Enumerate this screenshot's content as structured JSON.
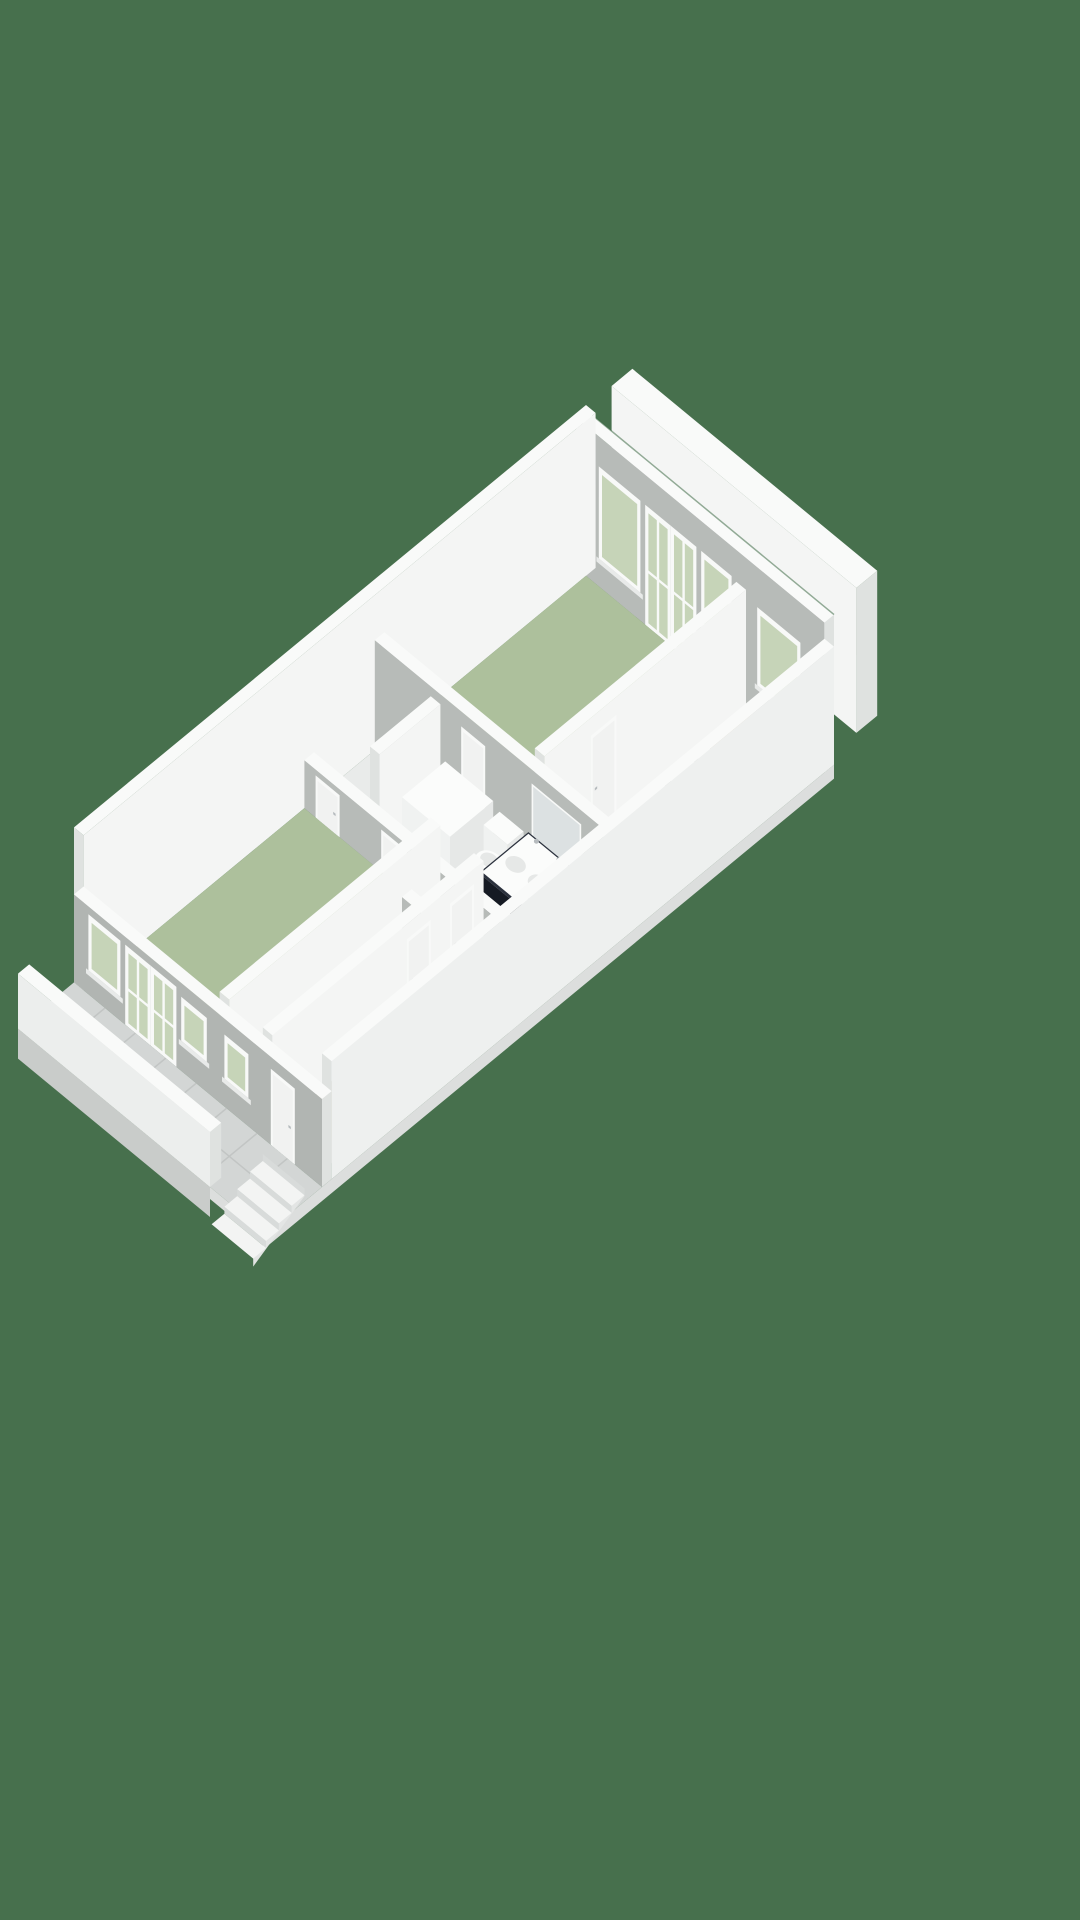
{
  "scene": {
    "canvas": {
      "width": 1080,
      "height": 1920
    },
    "iso": {
      "k": 0.8,
      "s": 0.66,
      "ox": 586,
      "oy": 560
    },
    "colors": {
      "background": "#47704d",
      "wall_top": "#f9faf9",
      "wall_light": "#f4f5f4",
      "wall_lighter": "#eef0ef",
      "wall_cap": "#dfe2e0",
      "wall_shade": "#b7bbb8",
      "facade": "#b1b5b2",
      "floor_green": "#adc09c",
      "floor_beige": "#c8bfaa",
      "floor_hall": "#c2b9a6",
      "floor_white": "#e9ebea",
      "tile": "#d3d6d5",
      "tile_seam": "#c2c5c4",
      "glazing": "#c6d4b8",
      "frame": "#f8f9f8",
      "sill": "#e8eae9",
      "door_panel": "#f1f2f1",
      "fixture_white": "#fbfcfb",
      "fixture_shade": "#e6e8e7",
      "fixture_side": "#f0f2f1",
      "vanity_top": "#2b313d",
      "vanity_front": "#151a23",
      "vanity_side": "#1f2530",
      "glass": "rgba(228,234,237,0.55)",
      "glass_edge": "#c7cdd1",
      "metal": "#b6bbbe",
      "step_top": "#f3f4f3",
      "step_riser": "#d8dbda",
      "step_side": "#e3e5e4",
      "base_edge": "#c9ccca",
      "base_light": "#dcdedd",
      "parapet_face": "#eceeed",
      "mirror": "#dce1e2",
      "seam_line": "#3e6a46"
    },
    "elements": [
      {
        "t": "box",
        "name": "neighbor-party-wall",
        "x1": -6,
        "y1": -64,
        "x2": 300,
        "y2": -38,
        "h": 145,
        "top": "wall_top",
        "fx": "wall_cap",
        "fy": "wall_light"
      },
      {
        "t": "box",
        "name": "exterior-wall-ne",
        "x1": 0,
        "y1": 0,
        "x2": 310,
        "y2": 12,
        "h": 150,
        "top": "wall_top",
        "fx": "wall_cap",
        "fy": "wall_shade"
      },
      {
        "t": "seam",
        "name": "wall-gap-shadow",
        "pts": [
          [
            0,
            0,
            150
          ],
          [
            310,
            0,
            150
          ]
        ]
      },
      {
        "t": "opening",
        "name": "bedroom-window",
        "plane": "y",
        "at": 12,
        "a1": 28,
        "a2": 80,
        "z1": 28,
        "z2": 120,
        "glaze": true,
        "sill": true
      },
      {
        "t": "opening",
        "name": "bedroom-french-door",
        "plane": "y",
        "at": 12,
        "a1": 86,
        "a2": 118,
        "z1": 0,
        "z2": 120,
        "glaze": true,
        "door": true
      },
      {
        "t": "opening",
        "name": "bedroom-french-door",
        "plane": "y",
        "at": 12,
        "a1": 118,
        "a2": 150,
        "z1": 0,
        "z2": 120,
        "glaze": true,
        "door": true
      },
      {
        "t": "opening",
        "name": "bedroom-window",
        "plane": "y",
        "at": 12,
        "a1": 156,
        "a2": 194,
        "z1": 28,
        "z2": 120,
        "glaze": true,
        "sill": true
      },
      {
        "t": "opening",
        "name": "wc-window",
        "plane": "y",
        "at": 12,
        "a1": 226,
        "a2": 280,
        "z1": 32,
        "z2": 110,
        "glaze": true,
        "sill": true
      },
      {
        "t": "box",
        "name": "exterior-wall-nw",
        "x1": 0,
        "y1": 0,
        "x2": 12,
        "y2": 640,
        "h": 155,
        "top": "wall_top",
        "fx": "wall_light",
        "fy": "wall_cap"
      },
      {
        "t": "floor",
        "name": "room-floor-bedroom",
        "x1": 12,
        "y1": 12,
        "x2": 200,
        "y2": 264,
        "fill": "floor_green"
      },
      {
        "t": "floor",
        "name": "room-floor-wc",
        "x1": 212,
        "y1": 12,
        "x2": 298,
        "y2": 110,
        "fill": "floor_beige"
      },
      {
        "t": "floor",
        "name": "room-floor-landing",
        "x1": 212,
        "y1": 122,
        "x2": 298,
        "y2": 264,
        "fill": "floor_white"
      },
      {
        "t": "floor",
        "name": "room-floor-closet",
        "x1": 12,
        "y1": 276,
        "x2": 82,
        "y2": 352,
        "fill": "floor_white"
      },
      {
        "t": "floor",
        "name": "room-floor-bathroom",
        "x1": 94,
        "y1": 276,
        "x2": 298,
        "y2": 352,
        "fill": "floor_white"
      },
      {
        "t": "floor",
        "name": "room-floor-living-room",
        "x1": 12,
        "y1": 364,
        "x2": 170,
        "y2": 628,
        "fill": "floor_green"
      },
      {
        "t": "floor",
        "name": "room-floor-storage",
        "x1": 182,
        "y1": 364,
        "x2": 224,
        "y2": 400,
        "fill": "floor_white"
      },
      {
        "t": "floor",
        "name": "room-floor-bedroom-2",
        "x1": 182,
        "y1": 412,
        "x2": 224,
        "y2": 628,
        "fill": "floor_green"
      },
      {
        "t": "floor",
        "name": "room-floor-hallway",
        "x1": 236,
        "y1": 364,
        "x2": 298,
        "y2": 628,
        "fill": "floor_hall"
      },
      {
        "t": "box",
        "name": "wc-toilet-tank",
        "x1": 248,
        "y1": 96,
        "x2": 278,
        "y2": 110,
        "h": 40,
        "top": "fixture_white",
        "fx": "fixture_shade",
        "fy": "fixture_side"
      },
      {
        "t": "pellipse",
        "name": "wc-toilet",
        "cx": 262,
        "cy": 82,
        "rx": 13,
        "ry": 10,
        "z": 18,
        "fill": "fixture_white"
      },
      {
        "t": "pellipse",
        "name": "wc-toilet-seat",
        "cx": 262,
        "cy": 82,
        "rx": 8,
        "ry": 6,
        "z": 20,
        "fill": "fixture_shade"
      },
      {
        "t": "box",
        "name": "wall-wc-front",
        "x1": 212,
        "y1": 110,
        "x2": 298,
        "y2": 122,
        "h": 55,
        "top": "wall_top",
        "fx": "wall_cap",
        "fy": "wall_shade"
      },
      {
        "t": "opening",
        "name": "wc-door",
        "plane": "y",
        "at": 122,
        "a1": 228,
        "a2": 258,
        "z1": 0,
        "z2": 48,
        "door": true
      },
      {
        "t": "box",
        "name": "wall-bedroom-side",
        "x1": 200,
        "y1": 12,
        "x2": 212,
        "y2": 264,
        "h": 118,
        "top": "wall_top",
        "fx": "wall_light",
        "fy": "wall_cap"
      },
      {
        "t": "opening",
        "name": "bedroom-door",
        "plane": "x",
        "at": 212,
        "a1": 174,
        "a2": 206,
        "z1": 0,
        "z2": 100,
        "door": true
      },
      {
        "t": "box",
        "name": "wall-central",
        "x1": 12,
        "y1": 264,
        "x2": 298,
        "y2": 276,
        "h": 110,
        "top": "wall_top",
        "fx": "wall_cap",
        "fy": "wall_shade"
      },
      {
        "t": "opening",
        "name": "bathroom-door",
        "plane": "y",
        "at": 276,
        "a1": 120,
        "a2": 150,
        "z1": 0,
        "z2": 95,
        "door": true
      },
      {
        "t": "opening",
        "name": "bathroom-mirror",
        "plane": "y",
        "at": 276,
        "a1": 208,
        "a2": 270,
        "z1": 36,
        "z2": 96,
        "mirror": true
      },
      {
        "t": "box",
        "name": "wall-closet-side",
        "x1": 82,
        "y1": 276,
        "x2": 94,
        "y2": 352,
        "h": 100,
        "top": "wall_top",
        "fx": "wall_light",
        "fy": "wall_cap"
      },
      {
        "t": "box",
        "name": "bathtub",
        "x1": 104,
        "y1": 280,
        "x2": 164,
        "y2": 334,
        "h": 52,
        "top": "fixture_white",
        "fx": "fixture_shade",
        "fy": "fixture_side"
      },
      {
        "t": "box",
        "name": "toilet-tank",
        "x1": 170,
        "y1": 278,
        "x2": 200,
        "y2": 298,
        "h": 44,
        "top": "fixture_white",
        "fx": "fixture_shade",
        "fy": "fixture_side"
      },
      {
        "t": "pellipse",
        "name": "toilet",
        "cx": 185,
        "cy": 306,
        "rx": 14,
        "ry": 11,
        "z": 22,
        "fill": "fixture_white"
      },
      {
        "t": "pellipse",
        "name": "toilet-seat",
        "cx": 185,
        "cy": 306,
        "rx": 9,
        "ry": 7,
        "z": 24,
        "fill": "fixture_shade"
      },
      {
        "t": "box",
        "name": "vanity-cabinet",
        "x1": 208,
        "y1": 280,
        "x2": 272,
        "y2": 342,
        "h": 50,
        "top": "vanity_top",
        "fx": "vanity_side",
        "fy": "vanity_front"
      },
      {
        "t": "floorz",
        "name": "vanity-counter",
        "x1": 210,
        "y1": 282,
        "x2": 270,
        "y2": 340,
        "z": 51,
        "fill": "fixture_white"
      },
      {
        "t": "pellipse",
        "name": "sink-basin",
        "cx": 226,
        "cy": 314,
        "rx": 10,
        "ry": 8,
        "z": 52,
        "fill": "fixture_shade"
      },
      {
        "t": "pellipse",
        "name": "sink-basin",
        "cx": 254,
        "cy": 314,
        "rx": 10,
        "ry": 8,
        "z": 52,
        "fill": "fixture_shade"
      },
      {
        "t": "dot",
        "name": "faucet",
        "x": 226,
        "y": 288,
        "z": 58,
        "r": 2.5,
        "fill": "metal"
      },
      {
        "t": "dot",
        "name": "faucet",
        "x": 254,
        "y": 288,
        "z": 58,
        "r": 2.5,
        "fill": "metal"
      },
      {
        "t": "vquad",
        "name": "shower-screen",
        "pts": [
          [
            276,
            280,
            0
          ],
          [
            276,
            348,
            0
          ],
          [
            276,
            348,
            80
          ],
          [
            276,
            280,
            80
          ]
        ],
        "fill": "glass",
        "stroke": "glass_edge"
      },
      {
        "t": "vquad",
        "name": "shower-door",
        "pts": [
          [
            276,
            348,
            0
          ],
          [
            290,
            360,
            0
          ],
          [
            290,
            360,
            76
          ],
          [
            276,
            348,
            76
          ]
        ],
        "fill": "glass",
        "stroke": "glass_edge"
      },
      {
        "t": "dot",
        "name": "shower-handle",
        "x": 276,
        "y": 316,
        "z": 55,
        "r": 3,
        "fill": "metal"
      },
      {
        "t": "box",
        "name": "wall-bathroom-front",
        "x1": 12,
        "y1": 352,
        "x2": 298,
        "y2": 364,
        "h": 48,
        "top": "wall_top",
        "fx": "wall_cap",
        "fy": "wall_shade"
      },
      {
        "t": "opening",
        "name": "closet-door",
        "plane": "y",
        "at": 364,
        "a1": 26,
        "a2": 56,
        "z1": 0,
        "z2": 42,
        "door": true
      },
      {
        "t": "opening",
        "name": "bathroom-hall-door",
        "plane": "y",
        "at": 364,
        "a1": 108,
        "a2": 140,
        "z1": 0,
        "z2": 42,
        "door": true
      },
      {
        "t": "opening",
        "name": "hall-door",
        "plane": "y",
        "at": 364,
        "a1": 252,
        "a2": 284,
        "z1": 0,
        "z2": 42,
        "door": true
      },
      {
        "t": "box",
        "name": "wall-living-side",
        "x1": 170,
        "y1": 364,
        "x2": 182,
        "y2": 628,
        "h": 95,
        "top": "wall_top",
        "fx": "wall_light",
        "fy": "wall_cap"
      },
      {
        "t": "box",
        "name": "wall-storage-front",
        "x1": 182,
        "y1": 400,
        "x2": 224,
        "y2": 412,
        "h": 55,
        "top": "wall_top",
        "fx": "wall_cap",
        "fy": "wall_shade"
      },
      {
        "t": "box",
        "name": "wall-hall-side",
        "x1": 224,
        "y1": 364,
        "x2": 236,
        "y2": 628,
        "h": 95,
        "top": "wall_top",
        "fx": "wall_light",
        "fy": "wall_cap"
      },
      {
        "t": "opening",
        "name": "hallway-door",
        "plane": "x",
        "at": 236,
        "a1": 376,
        "a2": 406,
        "z1": 0,
        "z2": 80,
        "door": true
      },
      {
        "t": "opening",
        "name": "hallway-door",
        "plane": "x",
        "at": 236,
        "a1": 430,
        "a2": 460,
        "z1": 0,
        "z2": 80,
        "door": true
      },
      {
        "t": "stairs",
        "name": "staircase",
        "x1": 248,
        "x2": 294,
        "y0": 440,
        "n": 6,
        "dy": 14,
        "z0": 12,
        "dz": 5
      },
      {
        "t": "box",
        "name": "exterior-wall-se",
        "x1": 298,
        "y1": 0,
        "x2": 310,
        "y2": 628,
        "h": 118,
        "top": "wall_top",
        "fx": "wall_lighter",
        "fy": "wall_cap"
      },
      {
        "t": "box",
        "name": "exterior-wall-front",
        "x1": 0,
        "y1": 628,
        "x2": 310,
        "y2": 640,
        "h": 88,
        "top": "wall_top",
        "fx": "wall_cap",
        "fy": "facade"
      },
      {
        "t": "opening",
        "name": "living-window",
        "plane": "y",
        "at": 640,
        "a1": 18,
        "a2": 58,
        "z1": 24,
        "z2": 80,
        "glaze": true,
        "sill": true
      },
      {
        "t": "opening",
        "name": "living-french-door",
        "plane": "y",
        "at": 640,
        "a1": 64,
        "a2": 96,
        "z1": 0,
        "z2": 80,
        "glaze": true,
        "door": true
      },
      {
        "t": "opening",
        "name": "living-french-door",
        "plane": "y",
        "at": 640,
        "a1": 96,
        "a2": 128,
        "z1": 0,
        "z2": 80,
        "glaze": true,
        "door": true
      },
      {
        "t": "opening",
        "name": "living-window",
        "plane": "y",
        "at": 640,
        "a1": 134,
        "a2": 166,
        "z1": 30,
        "z2": 74,
        "glaze": true,
        "sill": true
      },
      {
        "t": "opening",
        "name": "bedroom2-window",
        "plane": "y",
        "at": 640,
        "a1": 188,
        "a2": 218,
        "z1": 28,
        "z2": 72,
        "glaze": true,
        "sill": true
      },
      {
        "t": "opening",
        "name": "entrance-door",
        "plane": "y",
        "at": 640,
        "a1": 246,
        "a2": 276,
        "z1": 0,
        "z2": 76,
        "door": true
      },
      {
        "t": "floor",
        "name": "balcony-floor",
        "x1": 0,
        "y1": 640,
        "x2": 310,
        "y2": 710,
        "fill": "tile"
      },
      {
        "t": "floor",
        "name": "tile-seam",
        "x1": 38,
        "y1": 640,
        "x2": 39.5,
        "y2": 710,
        "fill": "tile_seam"
      },
      {
        "t": "floor",
        "name": "tile-seam",
        "x1": 76,
        "y1": 640,
        "x2": 77.5,
        "y2": 710,
        "fill": "tile_seam"
      },
      {
        "t": "floor",
        "name": "tile-seam",
        "x1": 114,
        "y1": 640,
        "x2": 115.5,
        "y2": 710,
        "fill": "tile_seam"
      },
      {
        "t": "floor",
        "name": "tile-seam",
        "x1": 152,
        "y1": 640,
        "x2": 153.5,
        "y2": 710,
        "fill": "tile_seam"
      },
      {
        "t": "floor",
        "name": "tile-seam",
        "x1": 190,
        "y1": 640,
        "x2": 191.5,
        "y2": 710,
        "fill": "tile_seam"
      },
      {
        "t": "floor",
        "name": "tile-seam",
        "x1": 228,
        "y1": 640,
        "x2": 229.5,
        "y2": 710,
        "fill": "tile_seam"
      },
      {
        "t": "floor",
        "name": "tile-seam",
        "x1": 266,
        "y1": 640,
        "x2": 267.5,
        "y2": 710,
        "fill": "tile_seam"
      },
      {
        "t": "floor",
        "name": "tile-seam",
        "x1": 0,
        "y1": 674,
        "x2": 310,
        "y2": 675.5,
        "fill": "tile_seam"
      },
      {
        "t": "vquad",
        "name": "balcony-base",
        "pts": [
          [
            0,
            710,
            0
          ],
          [
            240,
            710,
            0
          ],
          [
            240,
            710,
            -30
          ],
          [
            0,
            710,
            -30
          ]
        ],
        "fill": "base_edge"
      },
      {
        "t": "vquad",
        "name": "porch-base",
        "pts": [
          [
            240,
            710,
            0
          ],
          [
            310,
            710,
            0
          ],
          [
            310,
            710,
            -12
          ],
          [
            240,
            710,
            -12
          ]
        ],
        "fill": "base_light"
      },
      {
        "t": "vquad",
        "name": "se-base",
        "pts": [
          [
            310,
            0,
            0
          ],
          [
            310,
            710,
            0
          ],
          [
            310,
            710,
            -14
          ],
          [
            310,
            0,
            -14
          ]
        ],
        "fill": "base_light"
      },
      {
        "t": "extstairs",
        "name": "entrance-stairs",
        "x1": 248,
        "x2": 300,
        "y0": 652,
        "n": 4,
        "dy": 16,
        "dz": 7
      },
      {
        "t": "box",
        "name": "balcony-parapet",
        "x1": 0,
        "y1": 696,
        "x2": 240,
        "y2": 710,
        "h": 55,
        "top": "wall_top",
        "fx": "wall_cap",
        "fy": "parapet_face"
      }
    ]
  }
}
